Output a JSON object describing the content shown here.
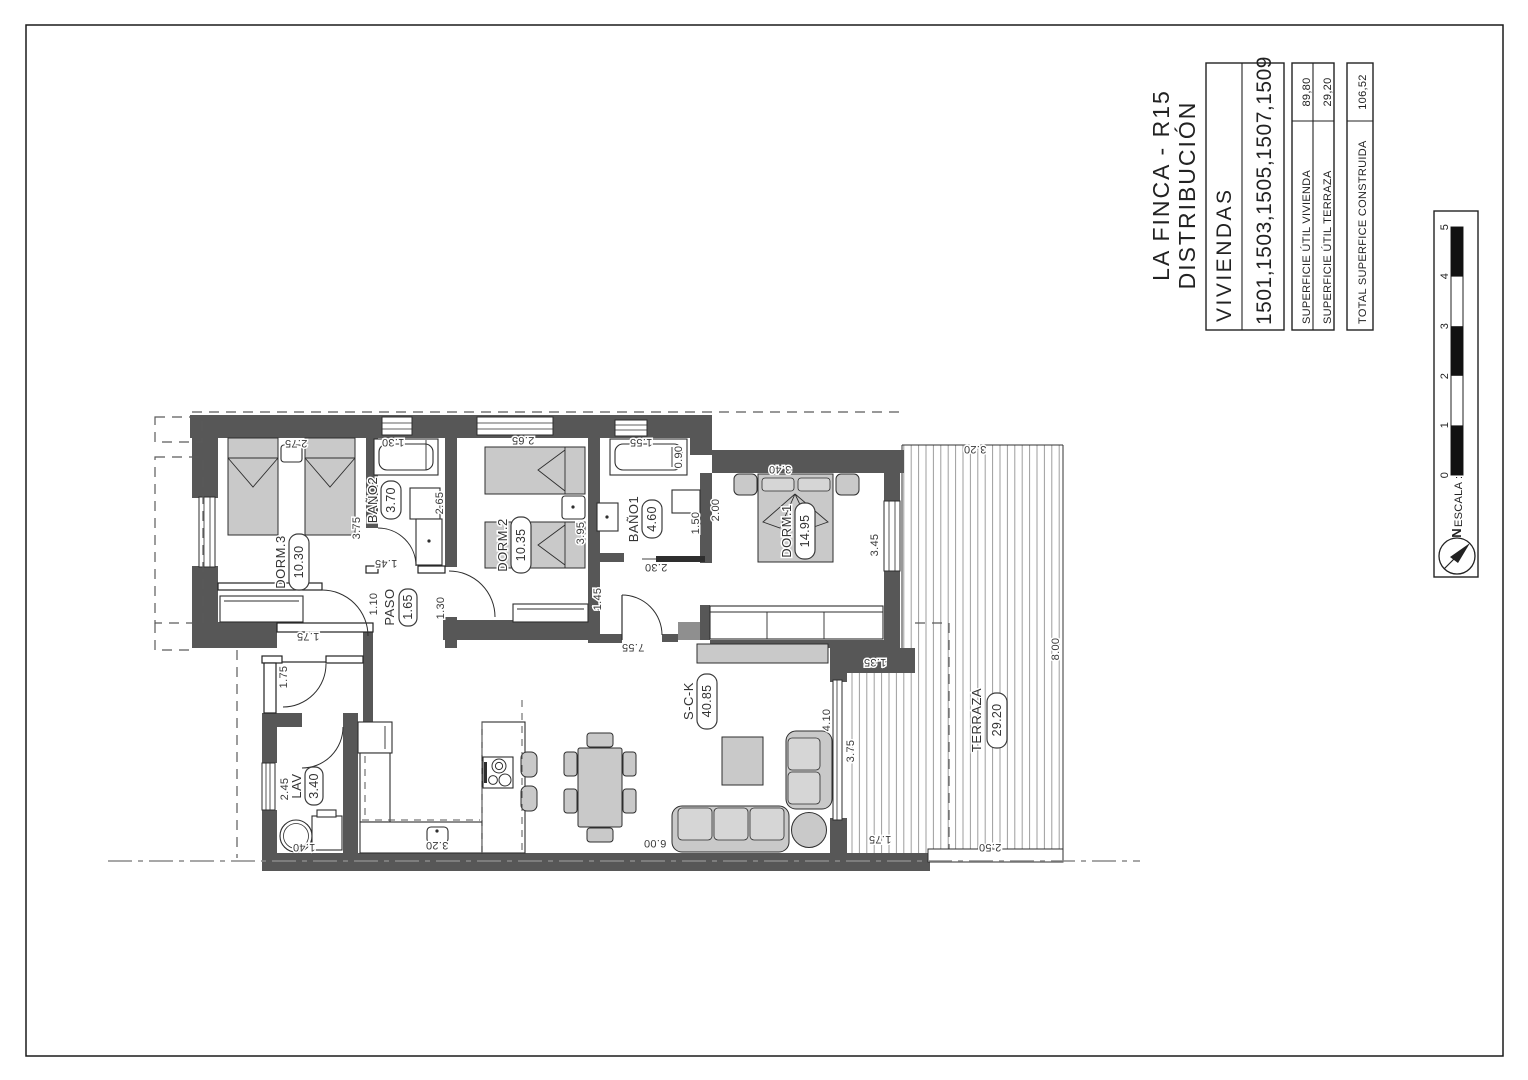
{
  "colors": {
    "wall": "#575757",
    "furniture": "#c9c9c9",
    "paper": "#ffffff",
    "line": "#2e2e2e"
  },
  "title_block": {
    "project": "LA FINCA - R15",
    "drawing": "DISTRIBUCIÓN",
    "viviendas_label": "VIVIENDAS",
    "viviendas_numbers": "1501,1503,1505,1507,1509",
    "areas": [
      {
        "label": "SUPERFICIE ÚTIL VIVIENDA",
        "value": "89,80"
      },
      {
        "label": "SUPERFICIE ÚTIL TERRAZA",
        "value": "29,20"
      }
    ],
    "total": {
      "label": "TOTAL SUPERFICE CONSTRUIDA",
      "value": "106,52"
    }
  },
  "scale_block": {
    "label": "ESCALA :",
    "north_label": "N",
    "ticks": [
      "0",
      "1",
      "2",
      "3",
      "4",
      "5"
    ]
  },
  "plan": {
    "rooms": [
      {
        "name": "DORM.3",
        "area": "10.30"
      },
      {
        "name": "BAÑO2",
        "area": "3.70"
      },
      {
        "name": "DORM.2",
        "area": "10.35"
      },
      {
        "name": "BAÑO1",
        "area": "4.60"
      },
      {
        "name": "DORM.1",
        "area": "14.95"
      },
      {
        "name": "PASO",
        "area": "1.65"
      },
      {
        "name": "LAV",
        "area": "3.40"
      },
      {
        "name": "S-C-K",
        "area": "40.85"
      },
      {
        "name": "TERRAZA",
        "area": "29.20"
      }
    ],
    "dims": [
      "2.75",
      "3.75",
      "1.45",
      "1.10",
      "1.75",
      "1.30",
      "2.65",
      "2.65",
      "3.95",
      "1.45",
      "1.30",
      "1.55",
      "0.90",
      "1.50",
      "2.00",
      "2.30",
      "3.40",
      "3.45",
      "7.55",
      "1.35",
      "4.10",
      "3.75",
      "6.00",
      "1.75",
      "2.50",
      "8.00",
      "3.20",
      "1.75",
      "2.45",
      "1.40",
      "3.20"
    ]
  }
}
